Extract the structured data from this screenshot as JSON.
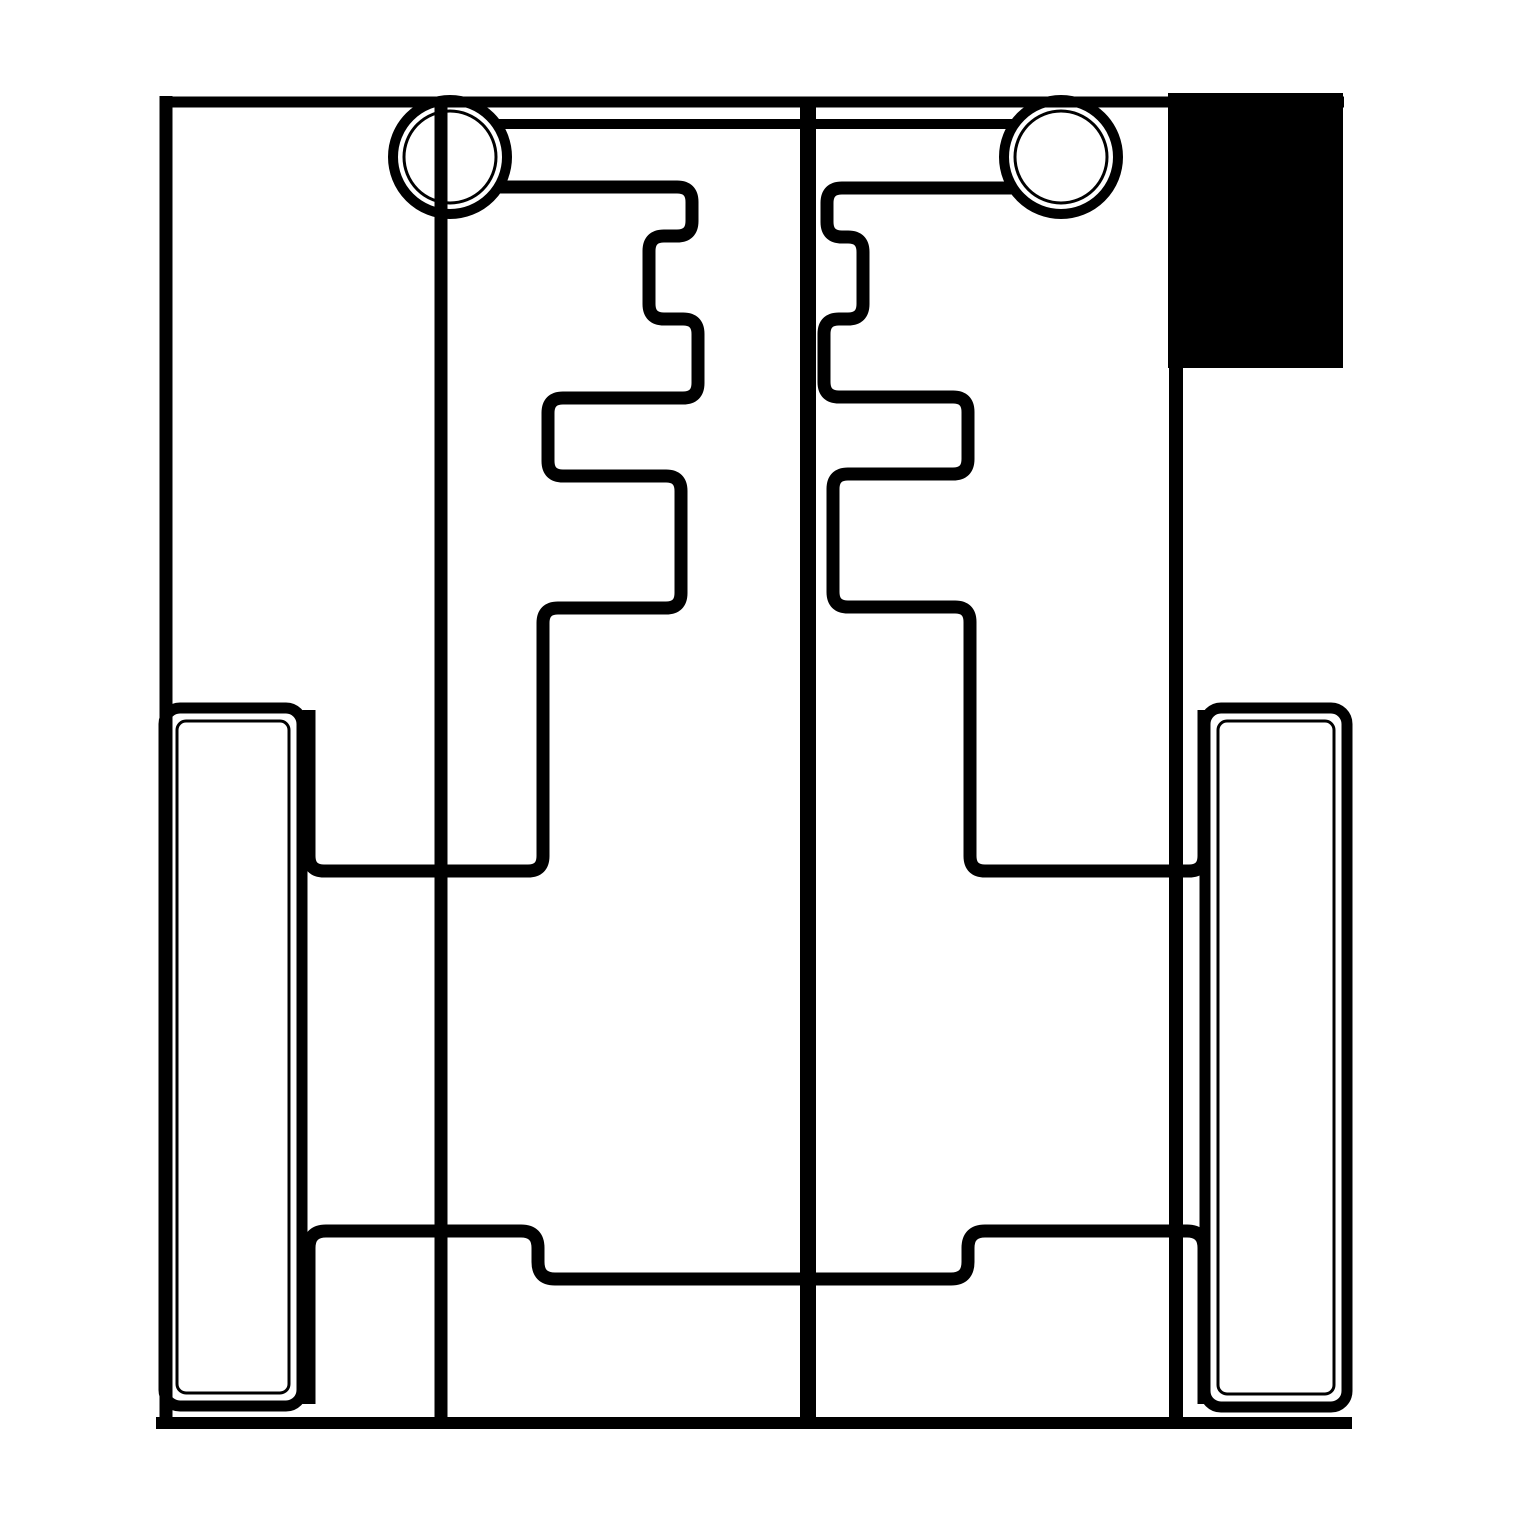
{
  "canvas": {
    "width": 1519,
    "height": 1519,
    "background_color": "#ffffff",
    "ink_color": "#000000"
  },
  "drawing": {
    "kind": "monochrome technical line drawing (mold/die cross-section style)",
    "shapes": [
      {
        "id": "guide-pin-bar",
        "type": "line",
        "x1": 455,
        "y1": 124,
        "x2": 1058,
        "y2": 124,
        "width": 10
      },
      {
        "id": "left-guide-pin-circle",
        "type": "circle",
        "cx": 450,
        "cy": 157,
        "r": 57,
        "width": 10,
        "inner_r": 46,
        "inner_width": 3,
        "fill": "#ffffff"
      },
      {
        "id": "right-guide-pin-circle",
        "type": "circle",
        "cx": 1061,
        "cy": 157,
        "r": 57,
        "width": 10,
        "inner_r": 46,
        "inner_width": 3,
        "fill": "#ffffff"
      },
      {
        "id": "outer-border-top",
        "type": "line",
        "x1": 160,
        "y1": 102,
        "x2": 1344,
        "y2": 102,
        "width": 11
      },
      {
        "id": "outer-border-left",
        "type": "line",
        "x1": 166,
        "y1": 96,
        "x2": 166,
        "y2": 1424,
        "width": 13
      },
      {
        "id": "outer-border-right",
        "type": "line",
        "x1": 1176,
        "y1": 94,
        "x2": 1176,
        "y2": 1424,
        "width": 14
      },
      {
        "id": "outer-border-bottom",
        "type": "line",
        "x1": 156,
        "y1": 1423,
        "x2": 1352,
        "y2": 1423,
        "width": 12
      },
      {
        "id": "left-axis-line",
        "type": "line",
        "x1": 441,
        "y1": 98,
        "x2": 441,
        "y2": 1423,
        "width": 13
      },
      {
        "id": "center-parting-line",
        "type": "line",
        "x1": 808,
        "y1": 98,
        "x2": 808,
        "y2": 1423,
        "width": 16
      },
      {
        "id": "left-step-profile",
        "type": "polyline",
        "width": 13,
        "radius": 15,
        "points": [
          [
            497,
            187
          ],
          [
            692,
            187
          ],
          [
            692,
            236
          ],
          [
            649,
            236
          ],
          [
            649,
            319
          ],
          [
            698,
            319
          ],
          [
            698,
            398
          ],
          [
            548,
            398
          ],
          [
            548,
            476
          ],
          [
            681,
            476
          ],
          [
            681,
            608
          ],
          [
            543,
            608
          ],
          [
            543,
            871
          ],
          [
            309,
            871
          ],
          [
            309,
            710
          ]
        ]
      },
      {
        "id": "right-step-profile",
        "type": "polyline",
        "width": 13,
        "radius": 15,
        "points": [
          [
            1015,
            188
          ],
          [
            827,
            188
          ],
          [
            827,
            237
          ],
          [
            863,
            237
          ],
          [
            863,
            319
          ],
          [
            824,
            319
          ],
          [
            824,
            397
          ],
          [
            968,
            397
          ],
          [
            968,
            474
          ],
          [
            833,
            474
          ],
          [
            833,
            607
          ],
          [
            970,
            607
          ],
          [
            970,
            871
          ],
          [
            1204,
            871
          ],
          [
            1204,
            710
          ]
        ]
      },
      {
        "id": "bottom-tray-profile",
        "type": "polyline",
        "width": 13,
        "radius": 17,
        "points": [
          [
            309,
            1404
          ],
          [
            309,
            1231
          ],
          [
            538,
            1231
          ],
          [
            538,
            1279
          ],
          [
            968,
            1279
          ],
          [
            968,
            1231
          ],
          [
            1204,
            1231
          ],
          [
            1204,
            1404
          ]
        ]
      },
      {
        "id": "left-plate",
        "type": "rect",
        "x": 164,
        "y": 708,
        "w": 138,
        "h": 698,
        "r": 16,
        "width": 11,
        "inner": {
          "x": 177,
          "y": 721,
          "w": 112,
          "h": 672,
          "r": 9,
          "width": 3
        }
      },
      {
        "id": "right-plate",
        "type": "rect",
        "x": 1205,
        "y": 708,
        "w": 142,
        "h": 699,
        "r": 16,
        "width": 11,
        "inner": {
          "x": 1218,
          "y": 721,
          "w": 116,
          "h": 673,
          "r": 9,
          "width": 3
        }
      },
      {
        "id": "corner-block",
        "type": "filled-rect",
        "x": 1168,
        "y": 93,
        "w": 175,
        "h": 275
      }
    ]
  }
}
